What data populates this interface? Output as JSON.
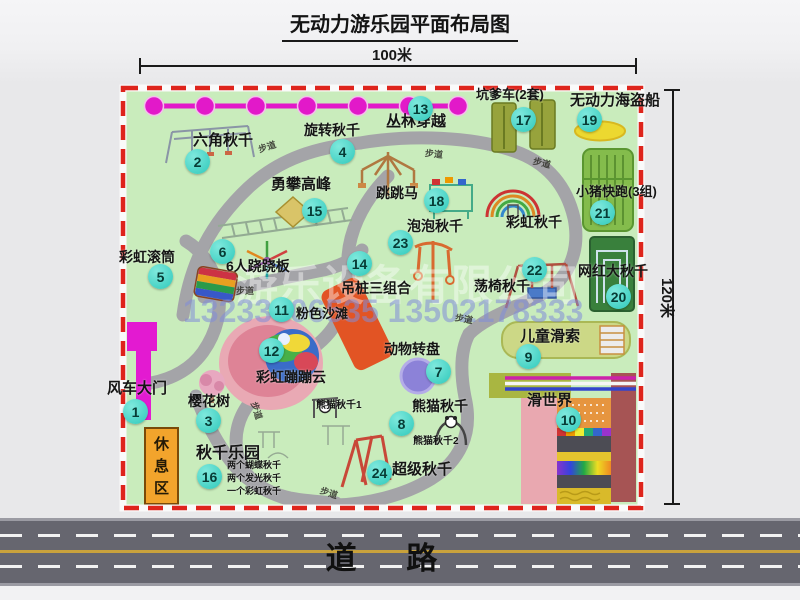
{
  "title": "无动力游乐园平面布局图",
  "dimensions": {
    "width": "100米",
    "height": "120米"
  },
  "watermark": {
    "company": "游乐设备有限公司",
    "phone": "13233806535 13502178333"
  },
  "road_label": "道路",
  "rest_area_label": "休息区",
  "trail_label": "步道",
  "attractions": {
    "a1": {
      "num": "1",
      "label": "风车大门"
    },
    "a2": {
      "num": "2",
      "label": "六角秋千"
    },
    "a3": {
      "num": "3",
      "label": "樱花树"
    },
    "a4": {
      "num": "4",
      "label": "旋转秋千"
    },
    "a5": {
      "num": "5",
      "label": "彩虹滚筒"
    },
    "a6": {
      "num": "6",
      "label": "6人跷跷板"
    },
    "a7": {
      "num": "7",
      "label": "动物转盘"
    },
    "a8": {
      "num": "8",
      "label": "熊猫秋千"
    },
    "a9": {
      "num": "9",
      "label": "儿童滑索"
    },
    "a10": {
      "num": "10",
      "label": "滑世界"
    },
    "a11": {
      "num": "11",
      "label": "粉色沙滩"
    },
    "a12": {
      "num": "12",
      "label": "彩虹蹦蹦云"
    },
    "a13": {
      "num": "13",
      "label": "丛林穿越"
    },
    "a14": {
      "num": "14",
      "label": "吊桩三组合"
    },
    "a15": {
      "num": "15",
      "label": "勇攀高峰"
    },
    "a16": {
      "num": "16",
      "label": "秋千乐园",
      "note1": "两个蝴蝶秋千",
      "note2": "两个发光秋千",
      "note3": "一个彩虹秋千"
    },
    "a17": {
      "num": "17",
      "label": "坑爹车(2套)"
    },
    "a18": {
      "num": "18",
      "label": "跳跳马"
    },
    "a19": {
      "num": "19",
      "label": "无动力海盗船"
    },
    "a20": {
      "num": "20",
      "label": "网红大秋千"
    },
    "a21": {
      "num": "21",
      "label": "小猪快跑(3组)"
    },
    "a22": {
      "num": "22",
      "label": "荡椅秋千"
    },
    "a23": {
      "num": "23",
      "label": "泡泡秋千"
    },
    "a24": {
      "num": "24",
      "label": "超级秋千"
    }
  },
  "sub_labels": {
    "rainbow_swing": "彩虹秋千",
    "panda_swing_1": "熊猫秋千1",
    "panda_swing_2": "熊猫秋千2"
  },
  "colors": {
    "map_bg": "#c9ecbc",
    "border_red": "#de241c",
    "badge_cyan": "#3fd6c6",
    "zipline_magenta": "#e219c9",
    "road_gray": "#66666f",
    "rest_area_orange": "#f2a42c",
    "gate_magenta": "#e31ad1"
  }
}
